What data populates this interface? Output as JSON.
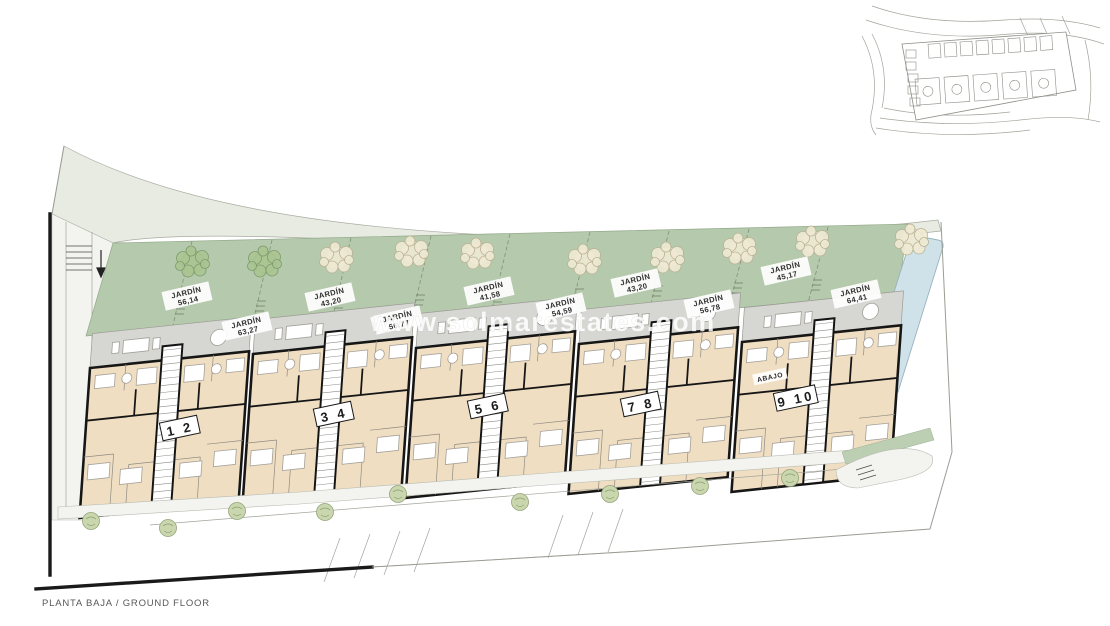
{
  "plan": {
    "title": "PLANTA BAJA / GROUND FLOOR",
    "watermark": "www.solmarestates.com",
    "abajo_label": "ABAJO",
    "gardens": [
      {
        "name": "JARDÍN",
        "area": "56,14"
      },
      {
        "name": "JARDÍN",
        "area": "63,27"
      },
      {
        "name": "JARDÍN",
        "area": "43,20"
      },
      {
        "name": "JARDÍN",
        "area": "56,77"
      },
      {
        "name": "JARDÍN",
        "area": "41,58"
      },
      {
        "name": "JARDÍN",
        "area": "54,59"
      },
      {
        "name": "JARDÍN",
        "area": "43,20"
      },
      {
        "name": "JARDÍN",
        "area": "56,78"
      },
      {
        "name": "JARDÍN",
        "area": "45,17"
      },
      {
        "name": "JARDÍN",
        "area": "64,41"
      }
    ],
    "unit_pairs": [
      {
        "label": "1 2"
      },
      {
        "label": "3 4"
      },
      {
        "label": "5 6"
      },
      {
        "label": "7 8"
      },
      {
        "label": "9 10"
      }
    ],
    "colors": {
      "garden_green": "#b5c9ac",
      "interior_tan": "#f0dec2",
      "terrace_grey": "#d6d7d2",
      "pool_blue": "#cfe2ea",
      "road_grey": "#e8ebe2",
      "wall_black": "#1a1a1a",
      "watermark_white": "#ffffff"
    }
  }
}
